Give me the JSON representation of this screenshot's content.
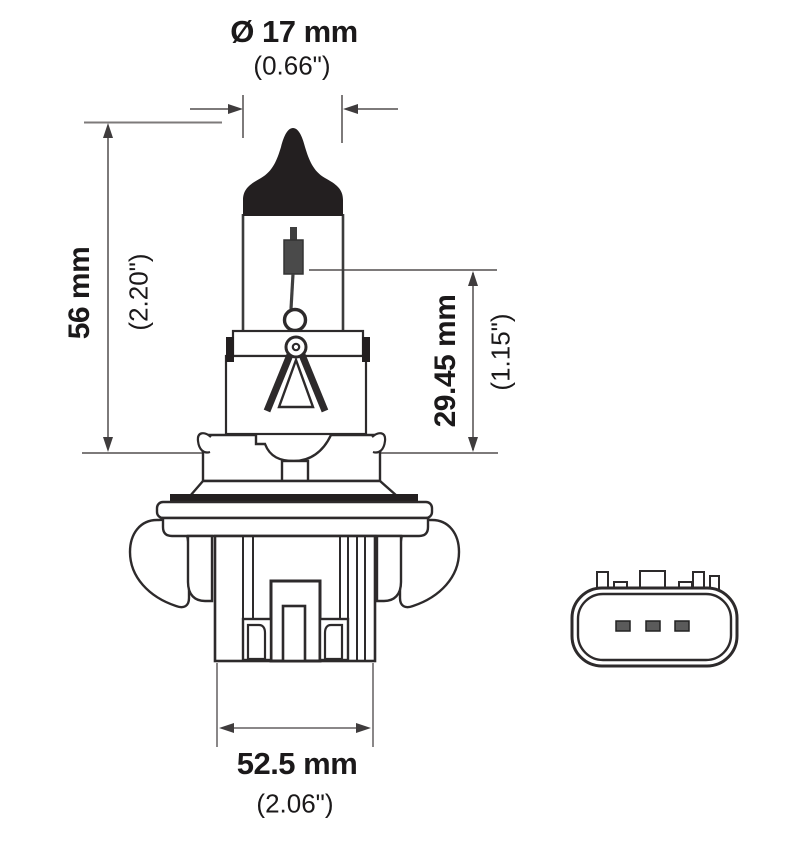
{
  "figure": {
    "title": "halogen bulb technical drawing",
    "views": {
      "main": "bulb side view with filament, collar, flange, retaining wings and ribbed base",
      "secondary": "3-pin connector face view"
    },
    "dimensions": {
      "top": {
        "metric": "Ø 17 mm",
        "imperial": "(0.66\")"
      },
      "left": {
        "metric": "56 mm",
        "imperial": "(2.20\")"
      },
      "right": {
        "metric": "29.45 mm",
        "imperial": "(1.15\")"
      },
      "bottom": {
        "metric": "52.5 mm",
        "imperial": "(2.06\")"
      }
    },
    "connector": {
      "pin_count": 3
    },
    "colors": {
      "background": "#ffffff",
      "outline_dark": "#2d2a2b",
      "fill_black": "#231f20",
      "dimension_gray": "#7d7a7a",
      "text": "#1b191a"
    }
  }
}
